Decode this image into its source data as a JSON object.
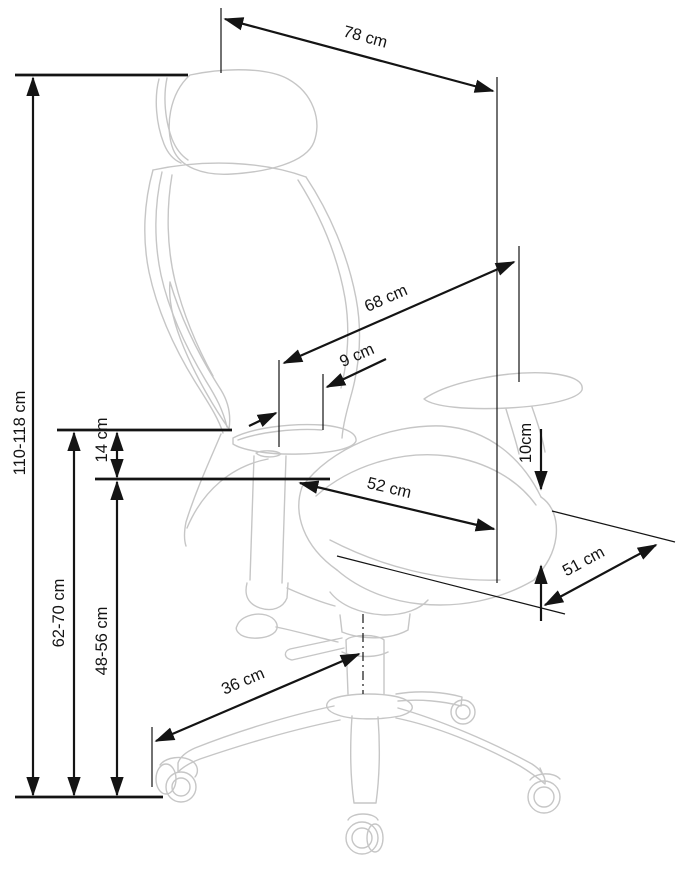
{
  "diagram": {
    "subject": "office chair side view with measurements",
    "unit": "cm",
    "colors": {
      "dimension_lines": "#141414",
      "chair_sketch": "#c6c6c6",
      "background": "#ffffff"
    },
    "dimensions": {
      "headrest_width": "78 cm",
      "backrest_length": "68 cm",
      "backrest_to_armrest": "9 cm",
      "total_height": "110-118 cm",
      "armrest_over_seat": "14 cm",
      "armrest_height": "62-70 cm",
      "seat_height": "48-56 cm",
      "seat_width": "52 cm",
      "seat_front_thickness": "10cm",
      "seat_depth": "51 cm",
      "base_leg_reach": "36 cm"
    }
  }
}
